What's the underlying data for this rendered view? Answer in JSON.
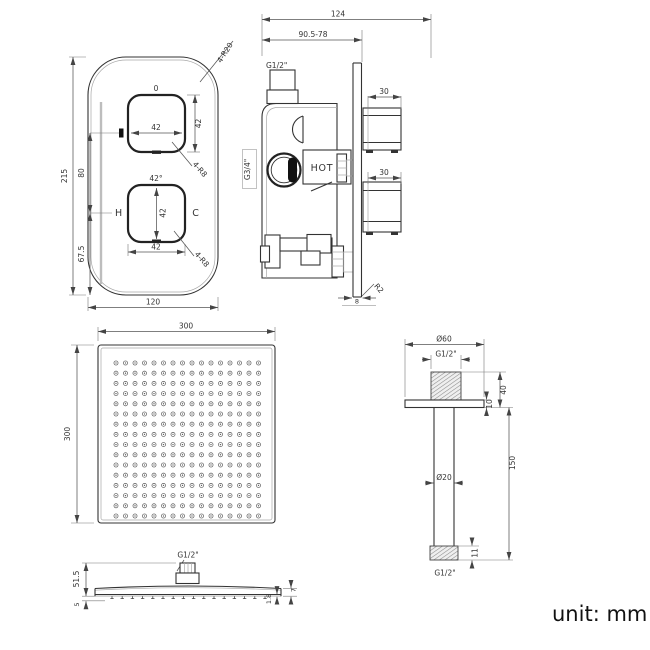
{
  "footer": {
    "unit_label": "unit: mm"
  },
  "valve_front": {
    "plate_corner_radius": "4-R20",
    "plate_height": "215",
    "knob_spacing": "80",
    "bottom_offset": "67.5",
    "plate_width": "120",
    "top_knob": {
      "position_label": "0",
      "width": "42",
      "height": "42",
      "corner_radius": "4-R8"
    },
    "bottom_knob": {
      "angle_label": "42°",
      "width": "42",
      "height": "42",
      "corner_radius": "4-R8",
      "hot_label": "H",
      "cold_label": "C"
    }
  },
  "valve_side": {
    "overall_depth": "124",
    "adjustable_depth": "90.5-78",
    "top_port_thread": "G1/2\"",
    "inlet_thread": "G3/4\"",
    "hot_marking": "HOT",
    "top_knob_depth": "30",
    "bottom_knob_depth": "30",
    "plate_thickness": "8",
    "plate_corner_radius": "R2"
  },
  "head_top": {
    "width": "300",
    "height": "300",
    "nozzle_grid": {
      "rows": 16,
      "cols": 16
    }
  },
  "arm": {
    "flange_diameter": "Ø60",
    "top_thread": "G1/2\"",
    "thread_flange_height": "40",
    "flange_thickness": "10",
    "tube_diameter": "Ø20",
    "drop_length": "150",
    "bottom_thread_length": "11",
    "bottom_thread": "G1/2\""
  },
  "head_side": {
    "connector_thread": "G1/2\"",
    "connector_height": "51.5",
    "edge_drop": "5",
    "rim_height": "7",
    "panel_thickness": "1.8",
    "nozzle_count": 16
  }
}
